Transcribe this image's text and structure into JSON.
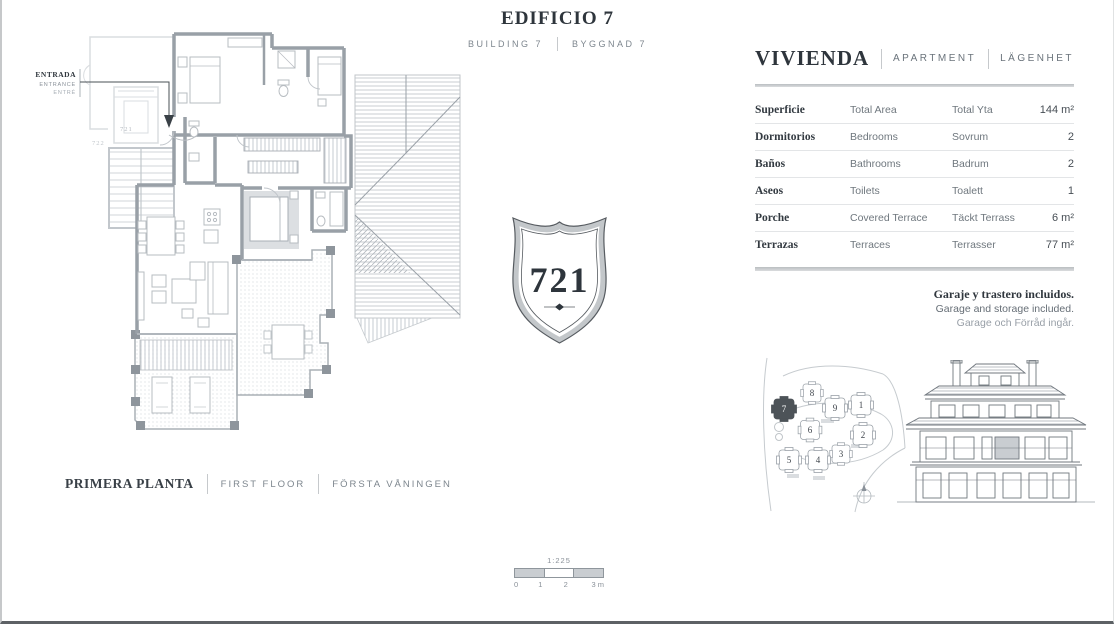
{
  "header": {
    "title": "EDIFICIO 7",
    "subtitle_en": "BUILDING 7",
    "subtitle_sv": "BYGGNAD 7"
  },
  "floor_plan": {
    "entrance_label": {
      "es": "ENTRADA",
      "en": "ENTRANCE",
      "sv": "ENTRÉ"
    },
    "unit_numbers": {
      "this_unit": "721",
      "adjacent_unit": "722"
    },
    "floor_label": {
      "es": "PRIMERA PLANTA",
      "en": "FIRST FLOOR",
      "sv": "FÖRSTA VÅNINGEN"
    }
  },
  "badge": {
    "number": "721"
  },
  "apartment_details": {
    "header": {
      "es": "VIVIENDA",
      "en": "APARTMENT",
      "sv": "LÄGENHET"
    },
    "rows": [
      {
        "es": "Superficie",
        "en": "Total Area",
        "sv": "Total Yta",
        "value": "144 m²"
      },
      {
        "es": "Dormitorios",
        "en": "Bedrooms",
        "sv": "Sovrum",
        "value": "2"
      },
      {
        "es": "Baños",
        "en": "Bathrooms",
        "sv": "Badrum",
        "value": "2"
      },
      {
        "es": "Aseos",
        "en": "Toilets",
        "sv": "Toalett",
        "value": "1"
      },
      {
        "es": "Porche",
        "en": "Covered Terrace",
        "sv": "Täckt Terrass",
        "value": "6 m²"
      },
      {
        "es": "Terrazas",
        "en": "Terraces",
        "sv": "Terrasser",
        "value": "77 m²"
      }
    ],
    "included_note": {
      "es": "Garaje y trastero incluidos.",
      "en": "Garage and storage included.",
      "sv": "Garage och Förråd ingår."
    }
  },
  "site_plan": {
    "building_numbers": [
      "1",
      "2",
      "3",
      "4",
      "5",
      "6",
      "7",
      "8",
      "9"
    ],
    "highlighted_building": "7"
  },
  "scale_bar": {
    "ratio": "1:225",
    "ticks": [
      "0",
      "1",
      "2",
      "3 m"
    ]
  },
  "colors": {
    "ink": "#2e353c",
    "muted": "#7d868e",
    "wall_gray": "#99a0a7",
    "rule_gray": "#c9cccf",
    "highlighted_building_fill": "#4d5358"
  }
}
